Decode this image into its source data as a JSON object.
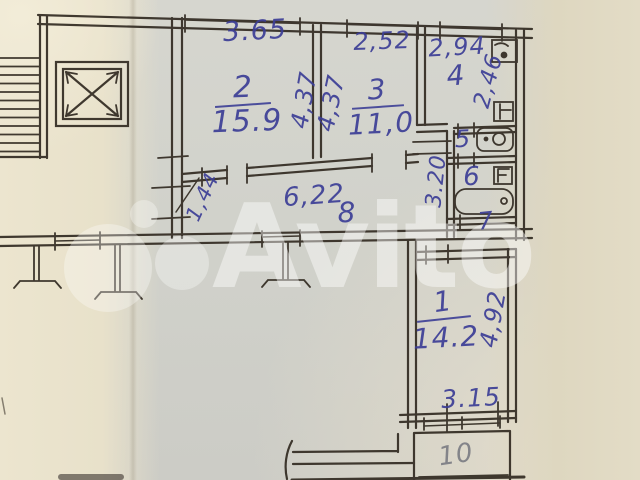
{
  "photo": {
    "description": "Scanned hand-drawn apartment floor plan on aged paper"
  },
  "colors": {
    "ink_blue": "#3c3e96",
    "pencil_gray": "#7c7d84",
    "wall_ink": "#332c23",
    "paper_left": "#e8e1ca",
    "paper_main": "#d1d2cb",
    "paper_right": "#e3dcc6",
    "watermark_white": "rgba(255,255,255,0.44)"
  },
  "icons": [
    "staircase-icon",
    "elevator-shaft-icon",
    "sink-icon",
    "toilet-icon",
    "bathtub-icon",
    "vent-shaft-icon",
    "balcony-post-icon"
  ],
  "rooms": {
    "r1": {
      "number": "1",
      "area": "14.2"
    },
    "r2": {
      "number": "2",
      "area": "15.9"
    },
    "r3": {
      "number": "3",
      "area": "11,0"
    },
    "r4": {
      "number": "4"
    },
    "r5": {
      "number": "5"
    },
    "r6": {
      "number": "6"
    },
    "r7": {
      "number": "7"
    },
    "r8": {
      "number": "8"
    },
    "r10": {
      "number": "10"
    }
  },
  "dimensions": {
    "room2_top": "3.65",
    "room3_top": "2,52",
    "hall_top": "2,94",
    "room2_side": "4,37",
    "room3_side": "4,37",
    "hall_side": "2,46",
    "bath_side": "3.20",
    "entry_side": "1,44",
    "corridor": "6,22",
    "room1_side": "4,92",
    "room1_bottom": "3.15"
  },
  "watermark": {
    "text": "Avito"
  }
}
